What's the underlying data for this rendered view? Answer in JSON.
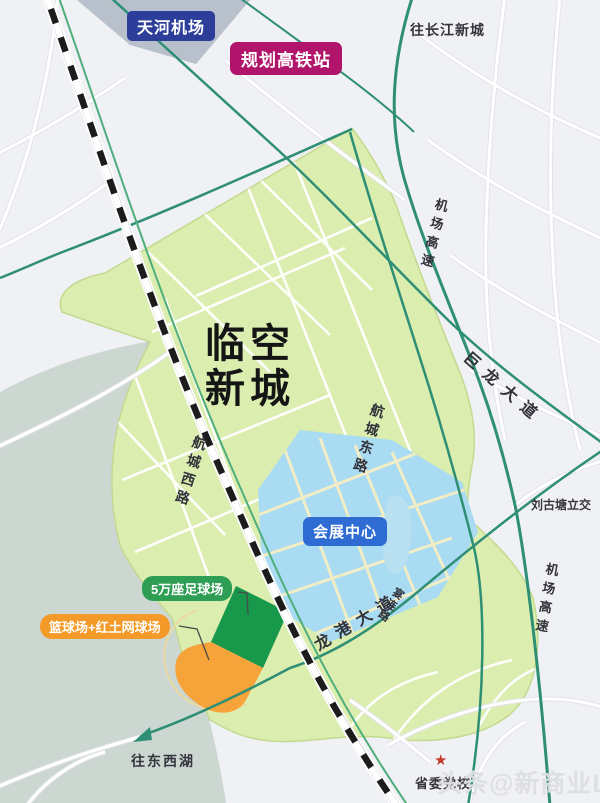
{
  "map_title": {
    "line1": "临空",
    "line2": "新城"
  },
  "labels": {
    "airport": "天河机场",
    "hsr_station": "规划高铁站",
    "convention_center": "会展中心",
    "stadium": "5万座足球场",
    "courts": "篮球场+红土网球场"
  },
  "roads": {
    "airport_expwy_north": "机场高速",
    "airport_expwy_south": "机场高速",
    "julong_ave": "巨龙大道",
    "hangcheng_east_rd": "航城东路",
    "hangcheng_west_rd": "航城西路",
    "longgang_ave": "龙港大道",
    "yanlian_rd": "宴连路"
  },
  "directions": {
    "to_changjiang_new_town": "往长江新城",
    "to_dongxihu": "往东西湖"
  },
  "pois": {
    "liugutang_interchange": "刘古塘立交",
    "party_school": "省委党校",
    "party_school_star": "★"
  },
  "watermark": "头条@新商业LAB",
  "colors": {
    "airport_label_bg": "#2c3e9a",
    "hsr_label_bg": "#b0156b",
    "convention_label_bg": "#2e6cd3",
    "stadium_label_bg": "#2f9e55",
    "courts_label_bg": "#f49a28",
    "newtown_area": "#dcedb0",
    "convention_area": "#a9dbf2",
    "stadium_parcel": "#18984a",
    "courts_parcel": "#f6a339",
    "pond_water": "#b9e0f1",
    "lake_area": "#ccd7d2",
    "road_green": "#2f8f74",
    "railway": "#1c1c1c"
  }
}
